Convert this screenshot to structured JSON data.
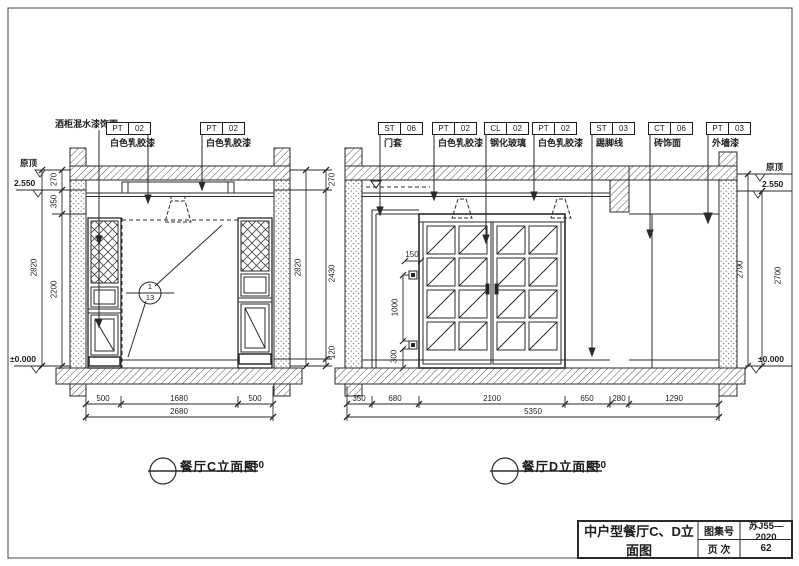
{
  "sheet": {
    "title_block": {
      "title": "中户型餐厅C、D立面图",
      "atlas_label": "图集号",
      "atlas_no": "苏J55—2020",
      "page_label": "页 次",
      "page_no": "62"
    }
  },
  "elev_c": {
    "caption": "餐厅C立面图",
    "scale": "1:50",
    "cabinet_note": "酒柜混水漆饰面",
    "tags": [
      {
        "code": "PT",
        "num": "02",
        "desc": "白色乳胶漆"
      },
      {
        "code": "PT",
        "num": "02",
        "desc": "白色乳胶漆"
      }
    ],
    "detail_ref": {
      "num": "1",
      "sheet": "13"
    },
    "levels": {
      "top": "原顶",
      "mid": "2.550",
      "bottom": "±0.000"
    },
    "dims_left": [
      "270",
      "350",
      "2200"
    ],
    "dims_left_total": "2820",
    "dims_right": [
      "270",
      "2430",
      "120"
    ],
    "dims_right_total": "2820",
    "dims_bottom": [
      "500",
      "1680",
      "500"
    ],
    "dims_bottom_total": "2680"
  },
  "elev_d": {
    "caption": "餐厅D立面图",
    "scale": "1:50",
    "tags": [
      {
        "code": "ST",
        "num": "06",
        "desc": "门套"
      },
      {
        "code": "PT",
        "num": "02",
        "desc": "白色乳胶漆"
      },
      {
        "code": "CL",
        "num": "02",
        "desc": "钢化玻璃"
      },
      {
        "code": "PT",
        "num": "02",
        "desc": "白色乳胶漆"
      },
      {
        "code": "ST",
        "num": "03",
        "desc": "踢脚线"
      },
      {
        "code": "CT",
        "num": "06",
        "desc": "砖饰面"
      },
      {
        "code": "PT",
        "num": "03",
        "desc": "外墙漆"
      }
    ],
    "levels": {
      "top": "原顶",
      "mid": "2.550",
      "bottom": "±0.000"
    },
    "dims_right": [
      "2790",
      "2700"
    ],
    "dims_socket": {
      "offset": "150",
      "spacing": "1000",
      "height": "300"
    },
    "dims_bottom": [
      "350",
      "680",
      "2100",
      "650",
      "280",
      "1290"
    ],
    "dims_bottom_total": "5350"
  }
}
